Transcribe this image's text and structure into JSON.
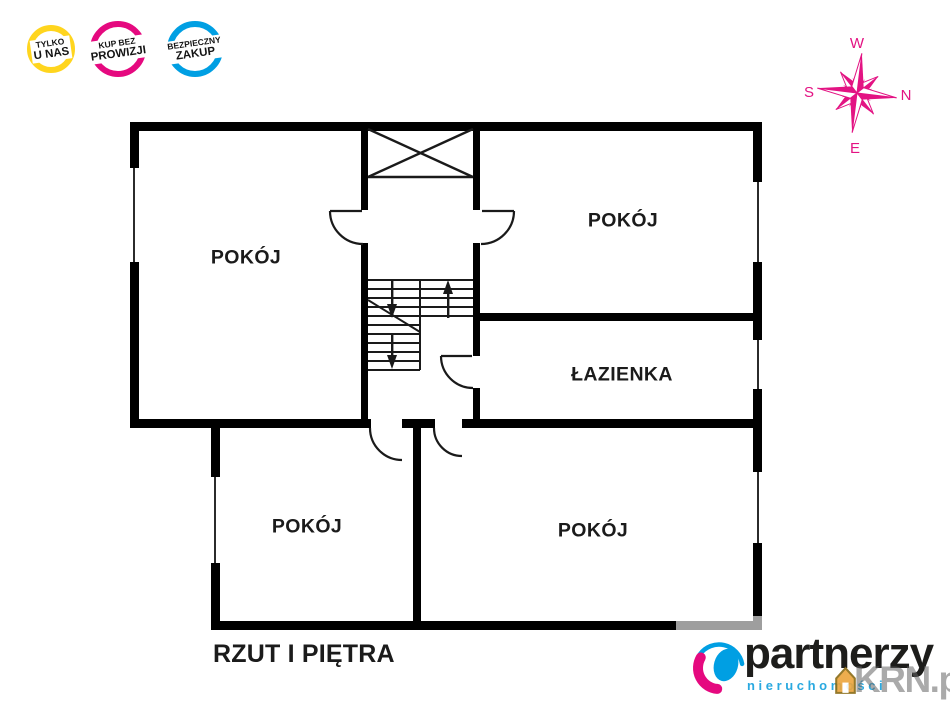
{
  "badges": [
    {
      "line1": "TYLKO",
      "line2": "U NAS",
      "color": "#FFD51E"
    },
    {
      "line1": "KUP BEZ",
      "line2": "PROWIZJI",
      "color": "#E5097F"
    },
    {
      "line1": "BEZPIECZNY",
      "line2": "ZAKUP",
      "color": "#009FE3"
    }
  ],
  "compass": {
    "top": "W",
    "right": "N",
    "left": "S",
    "bottom": "E",
    "color": "#E31383",
    "icon": "compass-rose-icon"
  },
  "plan": {
    "caption": "RZUT I PIĘTRA",
    "wall_color": "#000000",
    "rooms": [
      {
        "id": "room-top-left",
        "label": "POKÓJ"
      },
      {
        "id": "room-top-right",
        "label": "POKÓJ"
      },
      {
        "id": "bathroom",
        "label": "ŁAZIENKA"
      },
      {
        "id": "room-bottom-left",
        "label": "POKÓJ"
      },
      {
        "id": "room-bottom-right",
        "label": "POKÓJ"
      }
    ],
    "features": [
      "stairs-up-down",
      "void-x-shaft",
      "door-arcs",
      "windows"
    ]
  },
  "logo": {
    "name": "partnerzy",
    "subtitle": "nieruchomości",
    "name_color": "#1d1d1b",
    "subtitle_color": "#2AA9E0",
    "mark_blue": "#009FE3",
    "mark_pink": "#E5097F",
    "icon": "logo-mark-icon"
  },
  "watermark": {
    "text": "KRN.pl",
    "icon": "house-icon",
    "color": "rgba(100,100,100,0.55)"
  }
}
